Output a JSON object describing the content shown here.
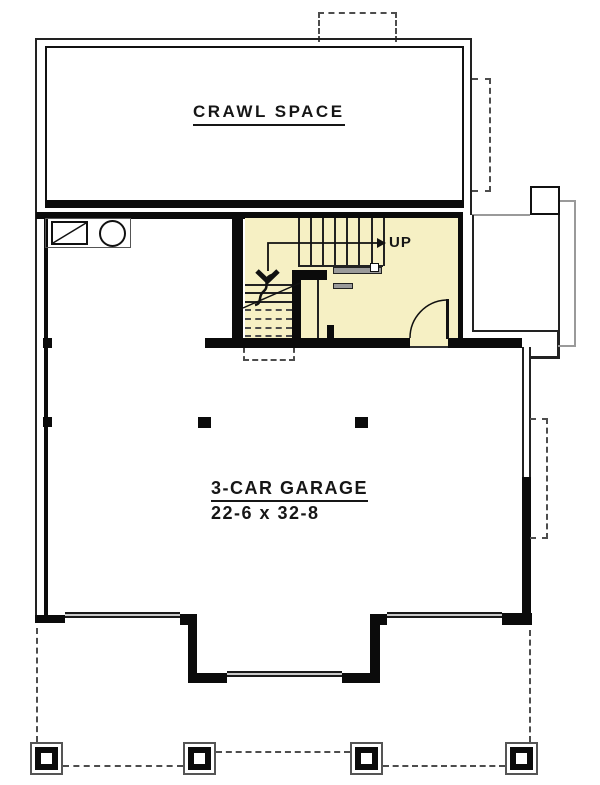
{
  "floor_plan": {
    "rooms": {
      "crawl_space": {
        "label": "CRAWL SPACE"
      },
      "garage": {
        "label": "3-CAR GARAGE",
        "dimensions": "22-6 x 32-8"
      },
      "stairs": {
        "direction_label": "UP"
      }
    },
    "features": {
      "garage_door_count": 3,
      "porch_post_count": 4,
      "utility_symbols": [
        "furnace",
        "water-heater"
      ]
    },
    "colors": {
      "stair_hall_fill": "#F6F0C4",
      "wall_black": "#0b0b0b",
      "overhang_gray": "#9a9a9a",
      "garage_door_gray": "#c9c9c9",
      "dashed_line_gray": "#4d4d4d",
      "background": "#ffffff"
    }
  }
}
